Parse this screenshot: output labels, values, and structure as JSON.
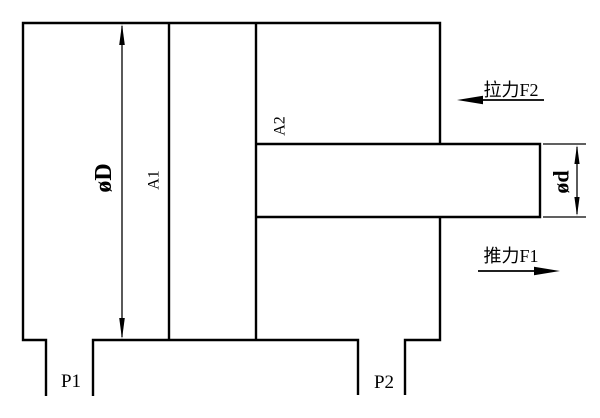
{
  "colors": {
    "line": "#000000",
    "background": "#ffffff"
  },
  "labels": {
    "bore_diameter": "øD",
    "piston_area": "A1",
    "rod_side_area": "A2",
    "rod_diameter": "ød",
    "pull_force": "拉力F2",
    "push_force": "推力F1",
    "port_1": "P1",
    "port_2": "P2"
  }
}
